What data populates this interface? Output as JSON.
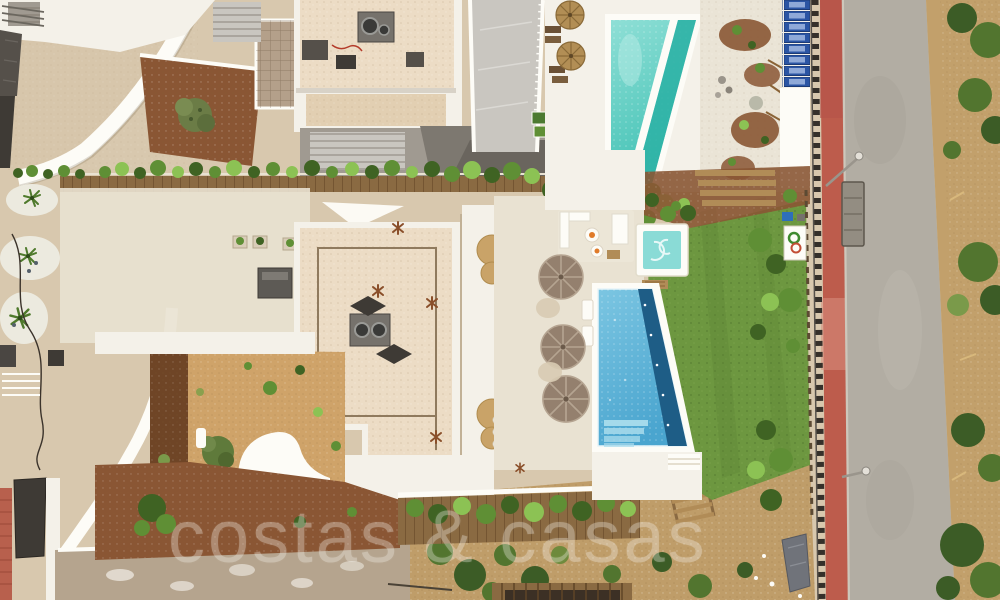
{
  "image": {
    "kind": "aerial-drone-photograph",
    "subject": "Modern luxury villa seen from above: two swimming pools, jacuzzi, lawn, parasol terrace, neighbouring villas, street with red footpath and unfinished construction strip",
    "width": 1000,
    "height": 600
  },
  "watermark": {
    "text": "costas & casas",
    "color": "#ffffff",
    "opacity": 0.34
  },
  "scene": {
    "pools": {
      "count": 2,
      "north_pool": "turquoise pool with separated lap lane",
      "main_pool": "blue mosaic pool with dark overflow lane and corner steps"
    },
    "jacuzzi": "white square spa with turquoise water",
    "parasols": {
      "terrace_parasols": 3,
      "thatch_palapas": 2
    },
    "lawn": "bright green turf beside main pool",
    "street": {
      "red_footpath": true,
      "asphalt_road": true,
      "dumpster": 1,
      "street_lamps": 2
    },
    "construction": "bare-earth strip with pergola framing along bottom edge"
  },
  "colors": {
    "base": "#d8c8ae",
    "white": "#f4f1e9",
    "whiteBright": "#fdfcf7",
    "cream": "#e9e2d2",
    "gravel": "#ecdcc5",
    "gravelDark": "#e2cfb2",
    "tanDrive": "#d7c6ab",
    "mulch": "#8a5634",
    "bark": "#6f4526",
    "sand": "#cfa369",
    "dirt": "#bf9d69",
    "concreteOld": "#b5a48e",
    "lawn": "#6d9740",
    "lawnDark": "#587f31",
    "hedgeDark": "#3f6323",
    "hedgeMid": "#5f8f35",
    "hedgeLight": "#8cc254",
    "turq": "#56cabf",
    "turqDeep": "#2fb3a6",
    "blue": "#55b1d8",
    "blueDeep": "#1e5d86",
    "blueLight": "#a9dcec",
    "road": "#b2ada3",
    "redPath": "#bd5c4c",
    "redTile": "#b8604d",
    "fenceDark": "#35302a",
    "wood": "#8a6a42",
    "woodLight": "#b18c57",
    "umbrella": "#94806e",
    "umbrellaSeam": "#b5a491",
    "thatch": "#b28e55",
    "thatchDark": "#8a6a38",
    "crate": "#2b55a4",
    "crateLight": "#8fa9d8",
    "slate": "#55504a",
    "slateDark": "#3e3a35",
    "ac": "#76726c",
    "acDark": "#4a4642",
    "greyTerrace": "#a09a91",
    "glass": "#c9c6c0",
    "stone": "#b4a08a",
    "scrubTan": "#c2a06b",
    "scrubGreen": "#52752f",
    "scrubDeep": "#3c5c26",
    "jacuzzi": "#8adbd6",
    "shadow": "rgba(90,70,45,0.18)"
  }
}
